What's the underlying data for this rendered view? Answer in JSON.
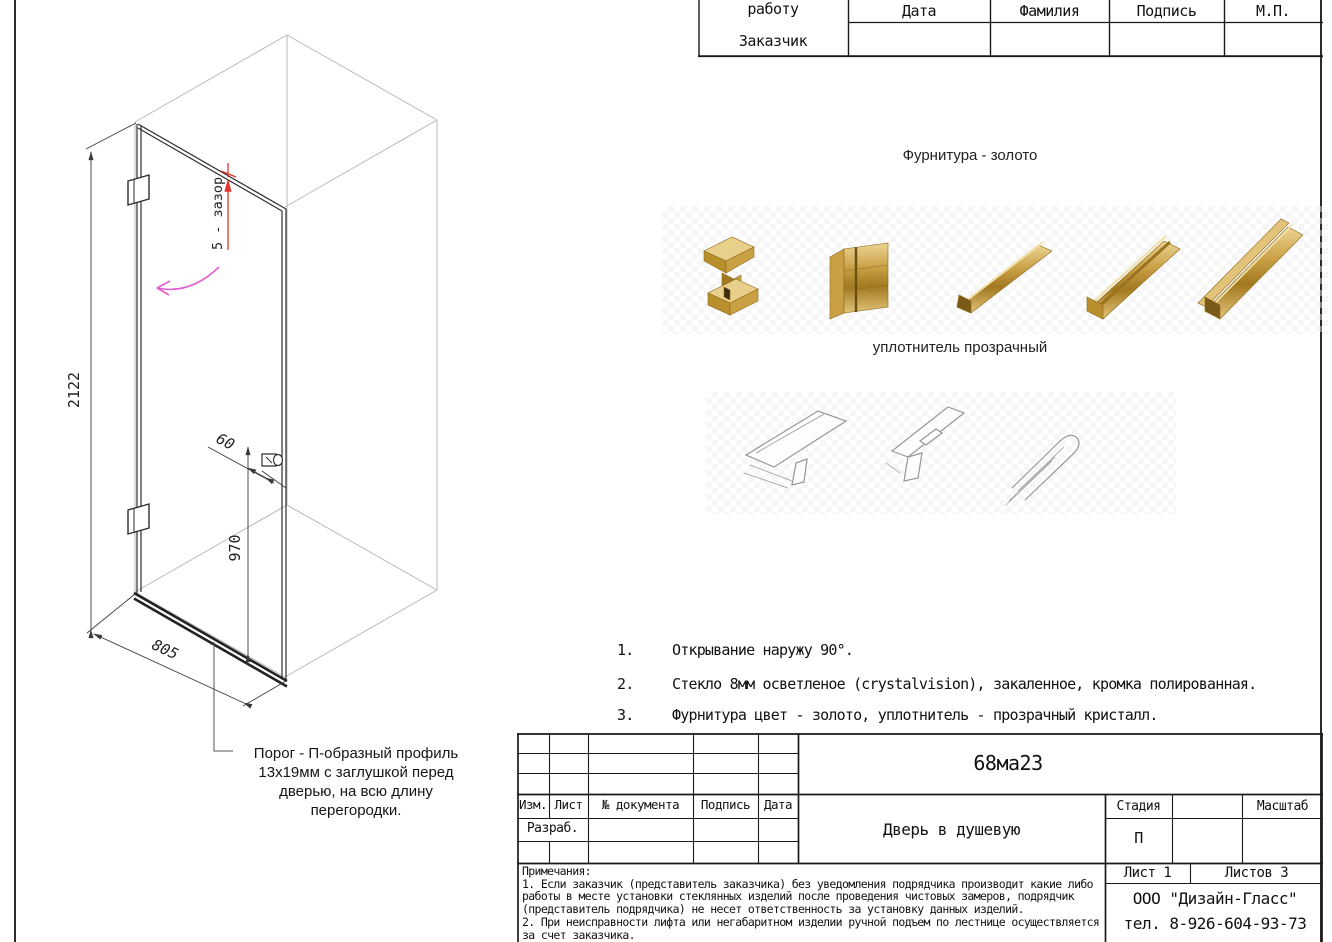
{
  "sheet": {
    "approval_table": {
      "row_label_top": "Запустить в работу",
      "row_label_bottom": "Заказчик",
      "columns": [
        "Дата",
        "Фамилия",
        "Подпись",
        "М.П."
      ]
    },
    "drawing": {
      "dims": {
        "height": "2122",
        "width": "805",
        "knob_height": "970",
        "knob_offset": "60"
      },
      "gap_note": "5 - зазор",
      "threshold_callout": "Порог - П-образный профиль 13х19мм с заглушкой перед дверью, на всю длину перегородки."
    },
    "hardware_section": {
      "title": "Фурнитура - золото"
    },
    "seal_section": {
      "title": "уплотнитель прозрачный"
    },
    "spec_notes": [
      {
        "num": "1.",
        "text": "Открывание наружу 90°."
      },
      {
        "num": "2.",
        "text": "Стекло 8мм осветленое (crystalvision), закаленное, кромка полированная."
      },
      {
        "num": "3.",
        "text": "Фурнитура цвет - золото, уплотнитель - прозрачный кристалл."
      }
    ],
    "title_block": {
      "code": "68ма23",
      "title": "Дверь в душевую",
      "col_izm": "Изм.",
      "col_list": "Лист",
      "col_doc": "№ документа",
      "col_sign": "Подпись",
      "col_date": "Дата",
      "razrab": "Разраб.",
      "stage_label": "Стадия",
      "stage_value": "П",
      "scale_label": "Масштаб",
      "sheet_no": "Лист 1",
      "sheets_total": "Листов 3",
      "company": "ООО \"Дизайн-Гласс\"",
      "phone": "тел. 8-926-604-93-73",
      "notes_title": "Примечания:",
      "notes": [
        "1. Если заказчик (представитель заказчика) без уведомления подрядчика производит какие либо работы в месте установки стеклянных изделий после проведения чистовых замеров, подрядчик (представитель подрядчика) не несет ответственность за установку данных изделий.",
        "2. При неисправности лифта или негабаритном изделии ручной подъем по лестнице осуществляется за счет заказчика."
      ]
    },
    "colors": {
      "dim_red": "#e53228",
      "swing_magenta": "#e25fd2",
      "gold": "#c9a227"
    }
  }
}
